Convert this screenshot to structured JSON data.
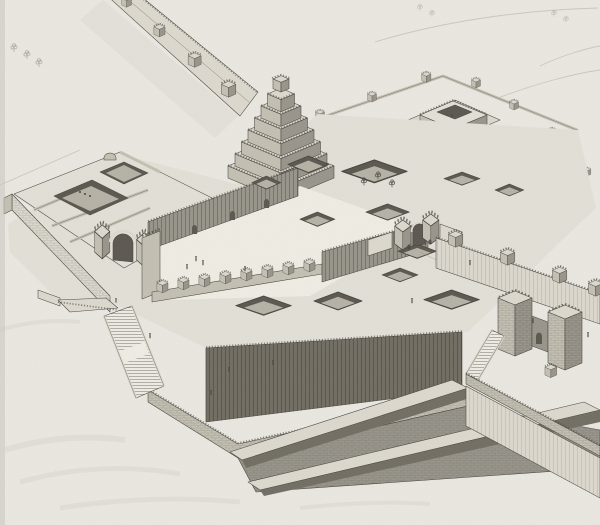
{
  "artwork": {
    "medium": "scanned black-and-white engraving plate",
    "subject": "Bird's-eye reconstruction of an Assyrian palace citadel on a raised terrace, with ziggurat, walled courts, ramps and staircases",
    "visible_features": [
      "crenellated city rampart with square towers receding to the upper left",
      "seven-tier stepped ziggurat with crenellated parapets and top shrine",
      "great inner courtyard bounded by a buttressed wall and a row of crenellated towers",
      "sunken light-well courtyards across the flat roofscape, one planted with trees",
      "walled temple enclosure with pilastered shrine at the upper right",
      "arched monumental gateways flanked by pylon towers",
      "massive terrace retaining walls with brick coursing",
      "two long access ramps descending to the plain at lower right",
      "double switch-back staircase at the lower left",
      "fortified outer gate with stair at the lower right",
      "tiny human figures for scale",
      "faint sketched trees and paths in the background"
    ],
    "counts": {
      "rampart_towers_visible": 4,
      "ziggurat_tiers": 7,
      "courtyard_tower_row": 8,
      "sunken_courtyards": 13
    }
  },
  "palette": {
    "paper": "#e9e7e0",
    "paper-shade": "#d9d6cc",
    "paper-edge": "#c9c6be",
    "ink": "#47443f",
    "line-soft": "#8f8b80",
    "face-light": "#e2dfd6",
    "face-lit": "#dcd8cd",
    "face-mid": "#c3bfb2",
    "face-shade": "#98948a",
    "face-dark": "#716d62",
    "pit-wall": "#5b574f",
    "pit-floor": "#b5b1a5",
    "bright": "#efece3"
  }
}
